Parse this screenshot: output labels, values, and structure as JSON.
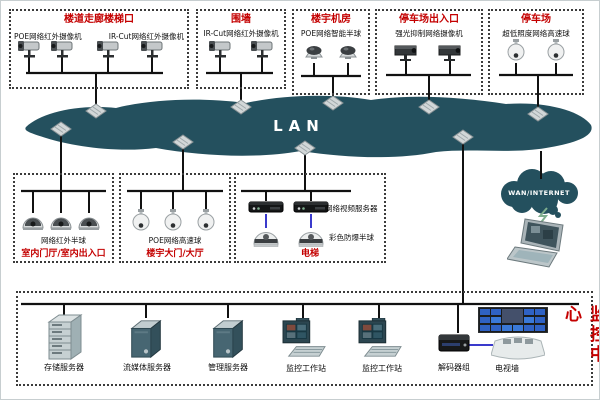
{
  "lan": {
    "label": "LAN"
  },
  "wan": {
    "label": "WAN/INTERNET"
  },
  "top_groups": [
    {
      "title": "楼道走廊楼梯口",
      "label_left": "POE网络红外摄像机",
      "label_right": "IR-Cut网络红外摄像机"
    },
    {
      "title": "围墙",
      "label": "IR-Cut网络红外摄像机"
    },
    {
      "title": "楼宇机房",
      "label": "POE网络智能半球"
    },
    {
      "title": "停车场出入口",
      "label": "强光抑制网络摄像机"
    },
    {
      "title": "停车场",
      "label": "超低照度网络高速球"
    }
  ],
  "lower_groups": [
    {
      "title": "室内门厅/室内出入口",
      "label": "网络红外半球"
    },
    {
      "title": "楼宇大门/大厅",
      "label": "POE网络高速球"
    },
    {
      "title": "电梯",
      "label_server": "网络视频服务器",
      "label_dome": "彩色防爆半球"
    }
  ],
  "monitoring_center": {
    "title_vertical": "监控中心",
    "device_labels": [
      "存储服务器",
      "流媒体服务器",
      "管理服务器",
      "监控工作站",
      "监控工作站",
      "解码器组",
      "电视墙"
    ]
  },
  "colors": {
    "lan_cloud": "#24505e",
    "title_red": "#c40000",
    "connector_black": "#111111",
    "link_blue": "#3a3acc"
  }
}
